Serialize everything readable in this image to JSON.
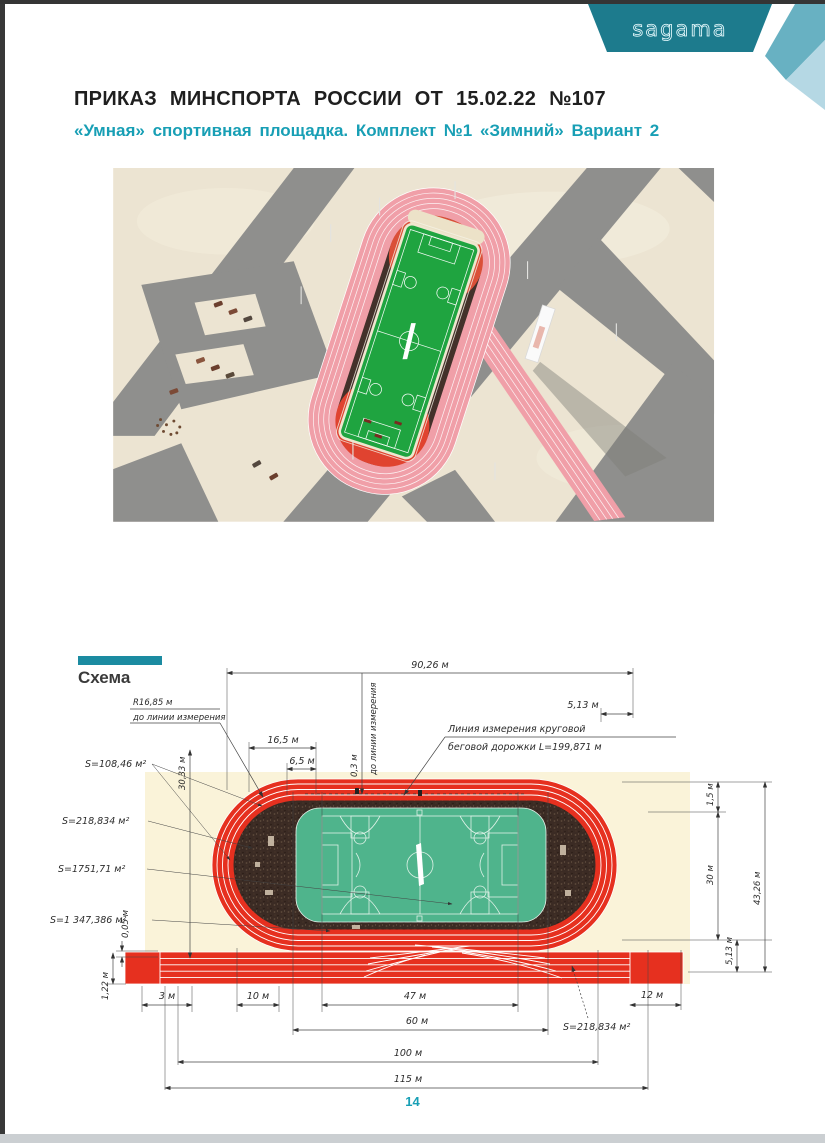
{
  "header": {
    "logo_text": "sagama",
    "title": "ПРИКАЗ МИНСПОРТА РОССИИ ОТ 15.02.22 №107",
    "subtitle": "«Умная» спортивная площадка. Комплект №1 «Зимний» Вариант 2"
  },
  "schema": {
    "section_label": "Схема",
    "dimensions": {
      "top_width": "90,26 м",
      "top_offset": "5,13 м",
      "radius_line1": "R16,85 м",
      "radius_line2": "до линии измерения",
      "seg_165": "16,5 м",
      "seg_65": "6,5 м",
      "offset_03": "0,3 м",
      "to_measure_line": "до линии измерения",
      "measure_line1": "Линия измерения круговой",
      "measure_line2": "беговой дорожки L=199,871 м",
      "left_height": "30,33 м",
      "area_track_ends": "S=108,46 м²",
      "area_sectors": "S=218,834 м²",
      "area_field": "S=1751,71 м²",
      "area_infield": "S=1 347,386 м²",
      "gap_005": "0,05 м",
      "lane_122": "1,22 м",
      "right_15": "1,5 м",
      "right_30": "30 м",
      "right_513": "5,13 м",
      "right_total": "43,26 м",
      "bottom_3": "3 м",
      "bottom_10": "10 м",
      "bottom_47": "47 м",
      "bottom_60": "60 м",
      "bottom_12": "12 м",
      "bottom_100": "100 м",
      "bottom_115": "115 м",
      "area_sectors_b": "S=218,834 м²"
    }
  },
  "page": {
    "number": "14"
  },
  "colors": {
    "accent": "#189fb5",
    "accent2": "#1b8ba1",
    "banner_dark": "#1d7b8d",
    "banner_mid": "#68b1c2",
    "banner_light": "#b5d8e4",
    "track_red": "#e6301f",
    "field_green": "#4fb48c",
    "cream": "#faf3d9",
    "snow": "#ece4d2",
    "road": "#8f8f8d",
    "infield_dark": "#3b2b24",
    "render_green": "#1fa440",
    "track_pink": "#f09fa8"
  }
}
